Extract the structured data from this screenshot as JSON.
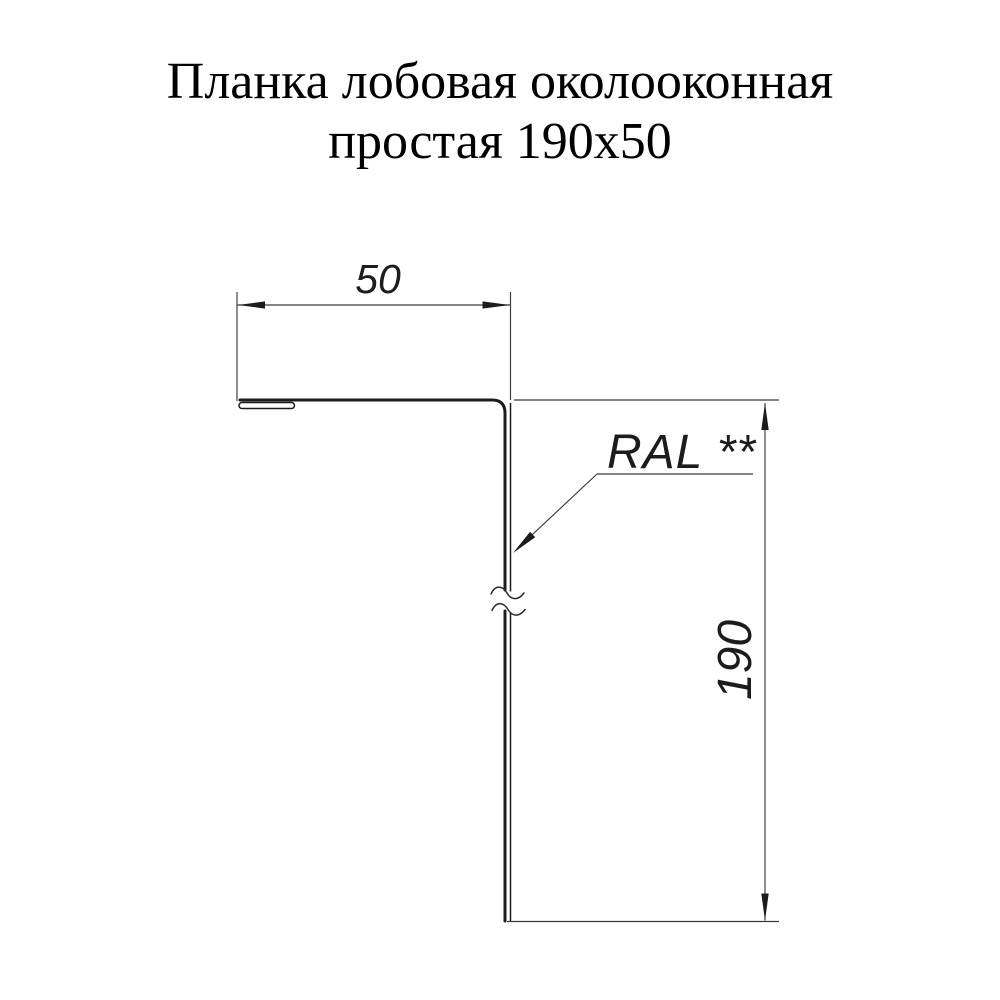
{
  "title": {
    "line1": "Планка лобовая околооконная",
    "line2": "простая 190х50"
  },
  "drawing": {
    "top_dimension": "50",
    "right_dimension": "190",
    "color_label": "RAL **",
    "line_color": "#1c1c1c",
    "background_color": "#ffffff"
  }
}
